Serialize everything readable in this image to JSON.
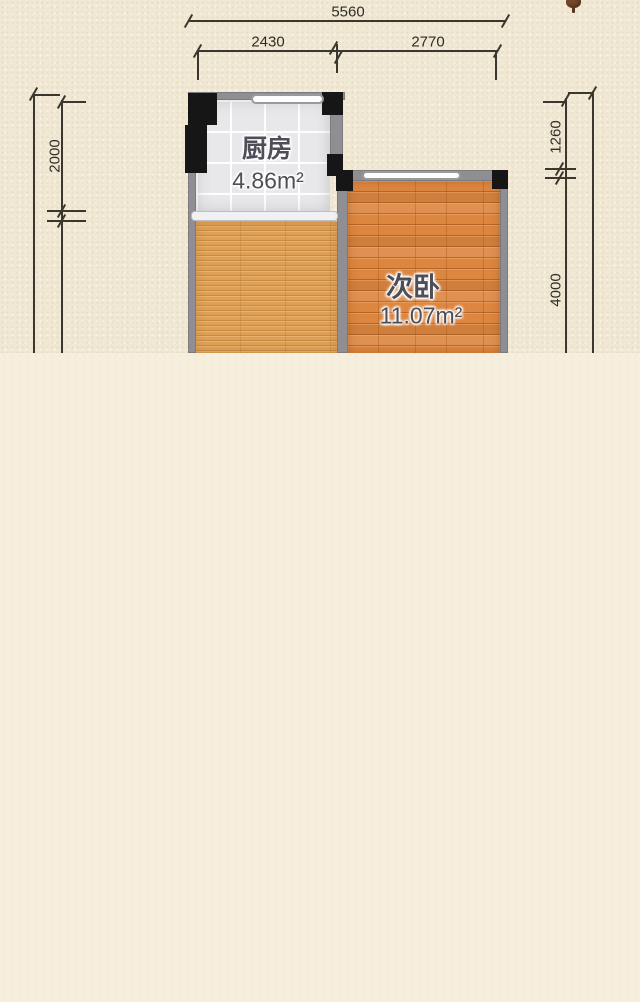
{
  "plan": {
    "rooms": {
      "kitchen": {
        "label": "厨房",
        "area": "4.86m²"
      },
      "bedroom": {
        "label": "次卧",
        "area": "11.07m²"
      }
    },
    "dims": {
      "total_width": "5560",
      "kitchen_width": "2430",
      "bedroom_width": "2770",
      "kitchen_depth": "2000",
      "right_upper": "1260",
      "bedroom_depth": "4000"
    },
    "colors": {
      "paper": "#f0e8d2",
      "page_background": "#f6efdd",
      "wall": "#8f8f93",
      "pillar": "#161616",
      "dimension_line": "#3a372e",
      "kitchen_floor": "#e8e8ea",
      "bedroom_floor": "#dd8640",
      "hall_floor": "#dfa055",
      "room_text": "#4e4e58"
    }
  }
}
